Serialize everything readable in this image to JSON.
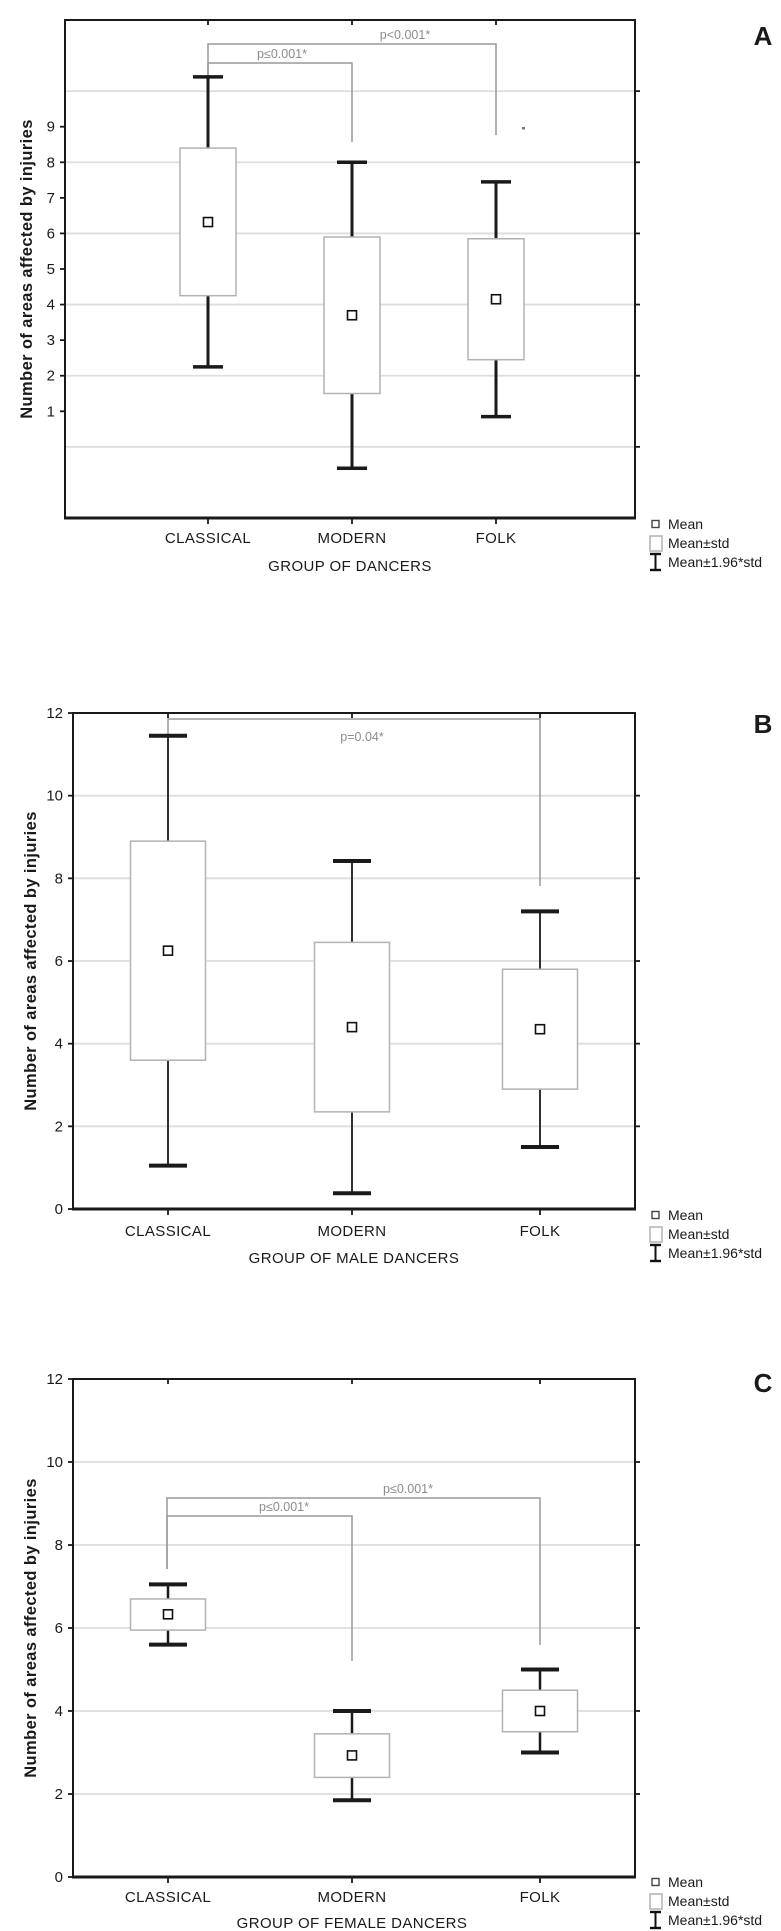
{
  "legend": {
    "items": [
      {
        "label": "Mean",
        "marker": "mean-square"
      },
      {
        "label": "Mean±std",
        "marker": "std-box"
      },
      {
        "label": "Mean±1.96*std",
        "marker": "whisker-ibeam"
      }
    ]
  },
  "colors": {
    "frame": "#1a1a1a",
    "gridline": "#dedede",
    "box_border": "#b2b2b2",
    "bracket": "#999999",
    "p_label": "#8c8c8c",
    "background": "#ffffff"
  },
  "chart_data": [
    {
      "type": "box",
      "panel_label": "A",
      "ylabel": "Number of areas affected by injuries",
      "xlabel": "GROUP OF DANCERS",
      "categories": [
        "CLASSICAL",
        "MODERN",
        "FOLK"
      ],
      "ylim": [
        -2,
        12
      ],
      "yticks": [
        1,
        2,
        3,
        4,
        5,
        6,
        7,
        8,
        9
      ],
      "gridlines": [
        0,
        2,
        4,
        6,
        8,
        10
      ],
      "right_ticks": [
        0,
        2,
        4,
        6,
        8,
        10
      ],
      "groups": [
        {
          "category": "CLASSICAL",
          "mean": 6.32,
          "std": 2.08,
          "box": [
            4.25,
            8.4
          ],
          "whiskers": [
            2.25,
            10.4
          ]
        },
        {
          "category": "MODERN",
          "mean": 3.7,
          "std": 2.2,
          "box": [
            1.5,
            5.9
          ],
          "whiskers": [
            -0.6,
            8.0
          ]
        },
        {
          "category": "FOLK",
          "mean": 4.15,
          "std": 1.7,
          "box": [
            2.45,
            5.85
          ],
          "whiskers": [
            0.85,
            7.45
          ]
        }
      ],
      "brackets": [
        {
          "from": "CLASSICAL",
          "to": "MODERN",
          "label": "p≤0.001*"
        },
        {
          "from": "CLASSICAL",
          "to": "FOLK",
          "label": "p<0.001*"
        }
      ]
    },
    {
      "type": "box",
      "panel_label": "B",
      "ylabel": "Number of areas affected by injuries",
      "xlabel": "GROUP OF MALE DANCERS",
      "categories": [
        "CLASSICAL",
        "MODERN",
        "FOLK"
      ],
      "ylim": [
        0,
        12
      ],
      "yticks": [
        0,
        2,
        4,
        6,
        8,
        10,
        12
      ],
      "gridlines": [
        2,
        4,
        6,
        8,
        10
      ],
      "right_ticks": [
        2,
        4,
        6,
        8,
        10
      ],
      "groups": [
        {
          "category": "CLASSICAL",
          "mean": 6.25,
          "std": 2.65,
          "box": [
            3.6,
            8.9
          ],
          "whiskers": [
            1.05,
            11.45
          ]
        },
        {
          "category": "MODERN",
          "mean": 4.4,
          "std": 2.05,
          "box": [
            2.35,
            6.45
          ],
          "whiskers": [
            0.38,
            8.42
          ]
        },
        {
          "category": "FOLK",
          "mean": 4.35,
          "std": 1.45,
          "box": [
            2.9,
            5.8
          ],
          "whiskers": [
            1.5,
            7.2
          ]
        }
      ],
      "brackets": [
        {
          "from": "CLASSICAL",
          "to": "FOLK",
          "label": "p=0.04*"
        }
      ]
    },
    {
      "type": "box",
      "panel_label": "C",
      "ylabel": "Number of areas affected by injuries",
      "xlabel": "GROUP OF FEMALE DANCERS",
      "categories": [
        "CLASSICAL",
        "MODERN",
        "FOLK"
      ],
      "ylim": [
        0,
        12
      ],
      "yticks": [
        0,
        2,
        4,
        6,
        8,
        10,
        12
      ],
      "gridlines": [
        2,
        4,
        6,
        8,
        10
      ],
      "right_ticks": [
        2,
        4,
        6,
        8,
        10
      ],
      "groups": [
        {
          "category": "CLASSICAL",
          "mean": 6.33,
          "std": 0.38,
          "box": [
            5.95,
            6.7
          ],
          "whiskers": [
            5.6,
            7.05
          ]
        },
        {
          "category": "MODERN",
          "mean": 2.93,
          "std": 0.53,
          "box": [
            2.4,
            3.45
          ],
          "whiskers": [
            1.85,
            4.0
          ]
        },
        {
          "category": "FOLK",
          "mean": 4.0,
          "std": 0.5,
          "box": [
            3.5,
            4.5
          ],
          "whiskers": [
            3.0,
            5.0
          ]
        }
      ],
      "brackets": [
        {
          "from": "CLASSICAL",
          "to": "MODERN",
          "label": "p≤0.001*"
        },
        {
          "from": "CLASSICAL",
          "to": "FOLK",
          "label": "p≤0.001*"
        }
      ]
    }
  ]
}
